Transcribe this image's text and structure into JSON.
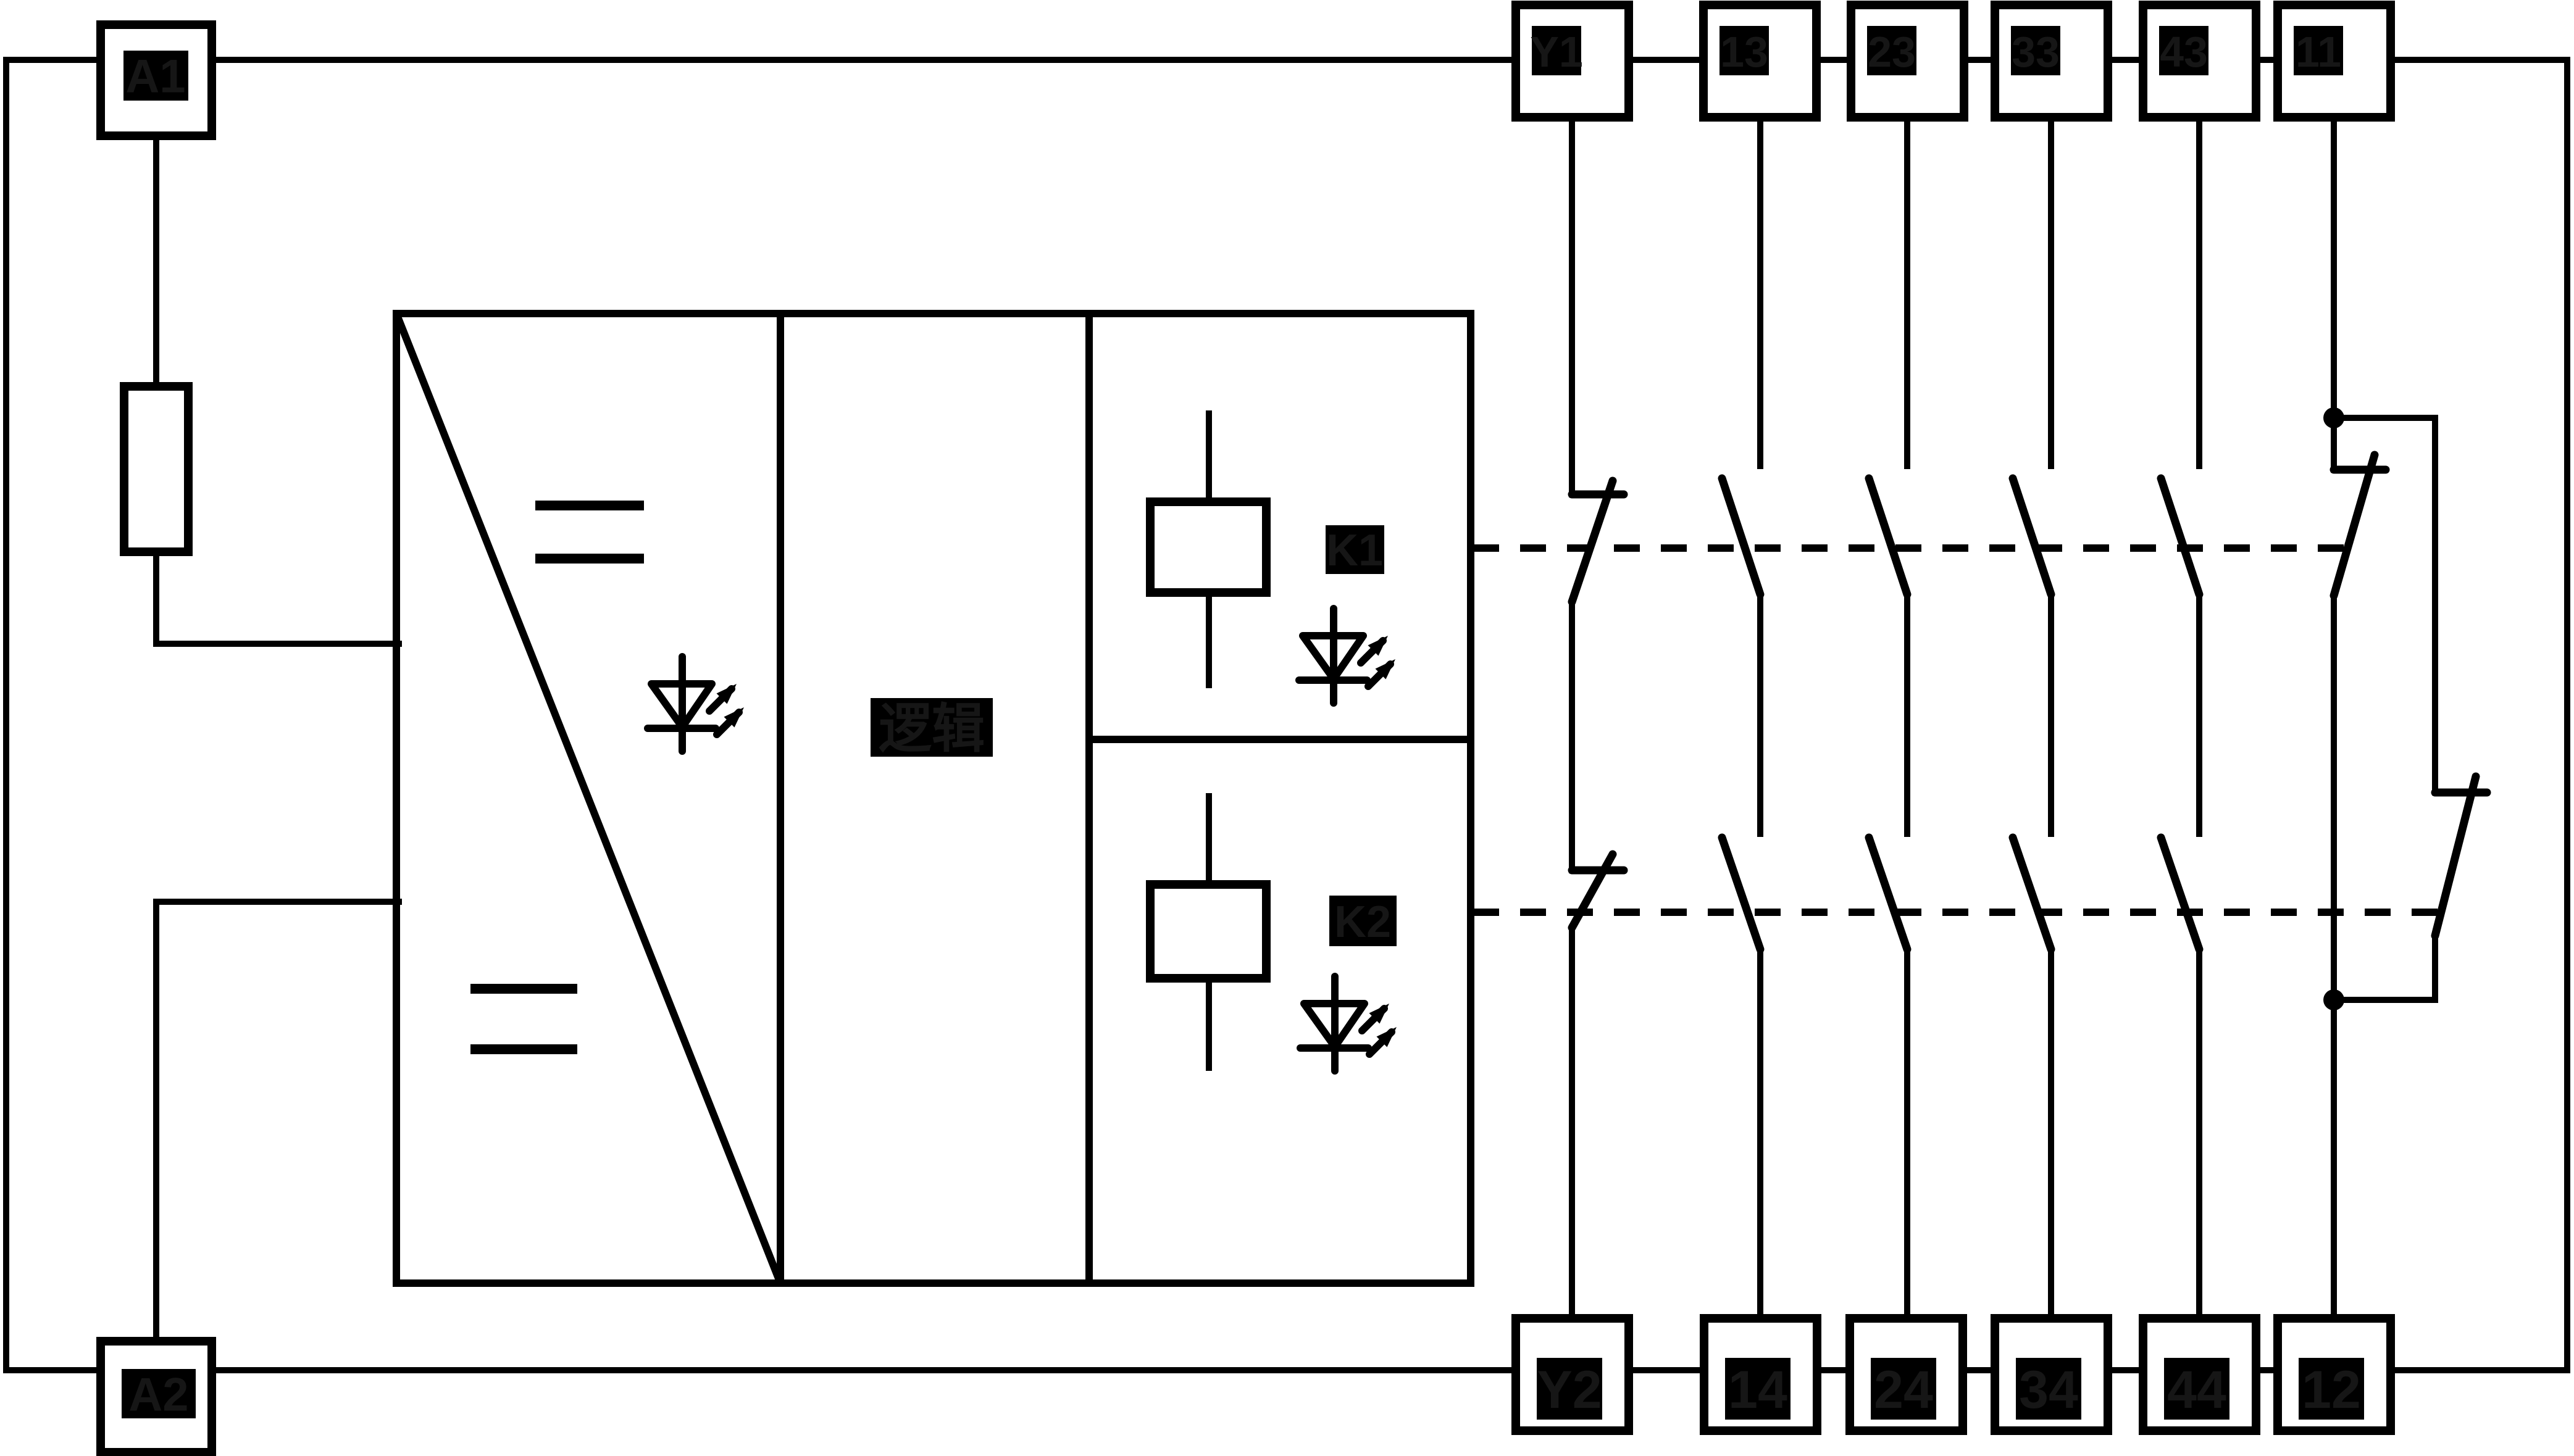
{
  "diagram": {
    "title": "safety relay internal wiring diagram",
    "background_color": "#ffffff",
    "line_color": "#000000",
    "hidden_label_color": "#161616",
    "power_terminals": {
      "a1": "A1",
      "a2": "A2"
    },
    "top_terminals": [
      "Y1",
      "13",
      "23",
      "33",
      "43",
      "11"
    ],
    "bottom_terminals": [
      "Y2",
      "14",
      "24",
      "34",
      "44",
      "12"
    ],
    "relays": {
      "k1": "K1",
      "k2": "K2"
    },
    "logic_block": "逻辑"
  }
}
